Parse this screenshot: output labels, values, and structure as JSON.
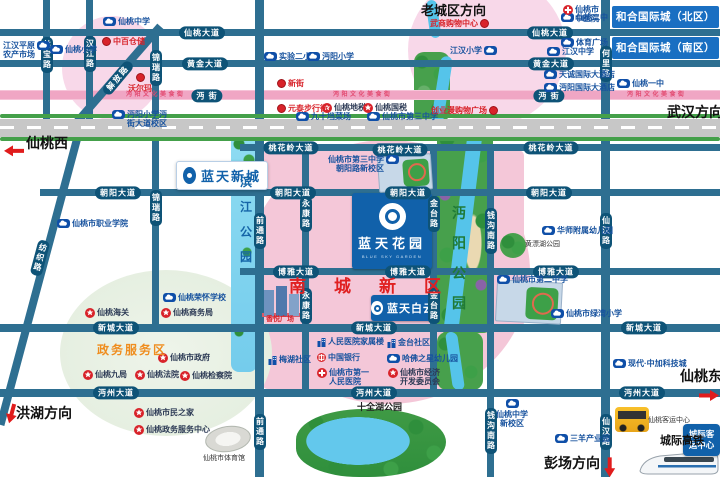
{
  "colors": {
    "road": "#2e6f91",
    "road_label_bg": "#0e5377",
    "pink_zone": "#f4c7d8",
    "pink_light": "#f8d8e9",
    "green_zone": "#e9f1e6",
    "river_blue": "#7cd4f0",
    "park_green": "#47a04c",
    "brand_blue": "#1161aa",
    "banner_blue": "#1a6fc2",
    "accent_red": "#d8232a",
    "highway_gray": "#c7c7c7"
  },
  "projects": {
    "xincheng": {
      "name": "蓝天新城"
    },
    "huayuan": {
      "name": "蓝天花园",
      "en": "BLUE SKY GARDEN"
    },
    "baiyun": {
      "name": "蓝天白云"
    },
    "chengji": {
      "name": "城际客运中心"
    }
  },
  "map": {
    "items": [
      {
        "k": "hp",
        "t": "仙桃大道",
        "x": 202,
        "y": 33
      },
      {
        "k": "hp",
        "t": "仙桃大道",
        "x": 550,
        "y": 33
      },
      {
        "k": "hp",
        "t": "黄金大道",
        "x": 205,
        "y": 64
      },
      {
        "k": "hp",
        "t": "黄金大道",
        "x": 551,
        "y": 64
      },
      {
        "k": "hp",
        "t": "沔  街",
        "x": 207,
        "y": 96
      },
      {
        "k": "hp",
        "t": "沔  街",
        "x": 549,
        "y": 96
      },
      {
        "k": "hp",
        "t": "桃花岭大道",
        "x": 291,
        "y": 148
      },
      {
        "k": "hp",
        "t": "桃花岭大道",
        "x": 400,
        "y": 150
      },
      {
        "k": "hp",
        "t": "桃花岭大道",
        "x": 551,
        "y": 148
      },
      {
        "k": "hp",
        "t": "朝阳大道",
        "x": 118,
        "y": 193
      },
      {
        "k": "hp",
        "t": "朝阳大道",
        "x": 293,
        "y": 193
      },
      {
        "k": "hp",
        "t": "朝阳大道",
        "x": 408,
        "y": 193
      },
      {
        "k": "hp",
        "t": "朝阳大道",
        "x": 549,
        "y": 193
      },
      {
        "k": "hp",
        "t": "博雅大道",
        "x": 296,
        "y": 272
      },
      {
        "k": "hp",
        "t": "博雅大道",
        "x": 408,
        "y": 272
      },
      {
        "k": "hp",
        "t": "博雅大道",
        "x": 556,
        "y": 272
      },
      {
        "k": "hp",
        "t": "新城大道",
        "x": 116,
        "y": 328
      },
      {
        "k": "hp",
        "t": "新城大道",
        "x": 374,
        "y": 328
      },
      {
        "k": "hp",
        "t": "新城大道",
        "x": 644,
        "y": 328
      },
      {
        "k": "hp",
        "t": "沔州大道",
        "x": 116,
        "y": 393
      },
      {
        "k": "hp",
        "t": "沔州大道",
        "x": 374,
        "y": 393
      },
      {
        "k": "hp",
        "t": "沔州大道",
        "x": 642,
        "y": 393
      },
      {
        "k": "vp",
        "t": "丝宝路",
        "x": 47,
        "y": 55
      },
      {
        "k": "vp",
        "t": "汉江路",
        "x": 90,
        "y": 54
      },
      {
        "k": "vp",
        "t": "锦瑞路",
        "x": 156,
        "y": 68
      },
      {
        "k": "vp",
        "t": "锦瑞路",
        "x": 156,
        "y": 208
      },
      {
        "k": "vp",
        "t": "何里路",
        "x": 606,
        "y": 64
      },
      {
        "k": "vp",
        "t": "前通路",
        "x": 260,
        "y": 231
      },
      {
        "k": "vp",
        "t": "前通路",
        "x": 260,
        "y": 432
      },
      {
        "k": "vp",
        "t": "永康路",
        "x": 306,
        "y": 214
      },
      {
        "k": "vp",
        "t": "永康路",
        "x": 306,
        "y": 306
      },
      {
        "k": "vp",
        "t": "金台路",
        "x": 434,
        "y": 214
      },
      {
        "k": "vp",
        "t": "金台路",
        "x": 434,
        "y": 306
      },
      {
        "k": "vp",
        "t": "钱沟南路",
        "x": 491,
        "y": 231
      },
      {
        "k": "vp",
        "t": "钱沟南路",
        "x": 491,
        "y": 431
      },
      {
        "k": "vp",
        "t": "仙汉路",
        "x": 606,
        "y": 231
      },
      {
        "k": "vp",
        "t": "仙汉路",
        "x": 606,
        "y": 432
      },
      {
        "k": "vp",
        "t": "纺织路",
        "x": 40,
        "y": 258,
        "rot": 15
      },
      {
        "k": "dp",
        "t": "解放路",
        "x": 118,
        "y": 78,
        "rot": -50
      },
      {
        "k": "pin",
        "t": "仙桃中学",
        "x": 103,
        "y": 17
      },
      {
        "k": "pin",
        "t": "江汉平原\n农产市场",
        "x": 3,
        "y": 41,
        "side": "l"
      },
      {
        "k": "pin",
        "t": "仙桃小学",
        "x": 50,
        "y": 45
      },
      {
        "k": "pin",
        "t": "实验二小",
        "x": 264,
        "y": 52
      },
      {
        "k": "pin",
        "t": "沔阳小学",
        "x": 307,
        "y": 52
      },
      {
        "k": "pin",
        "t": "九十垱菜场",
        "x": 296,
        "y": 112
      },
      {
        "k": "pin",
        "t": "仙桃市第三中学",
        "x": 367,
        "y": 112
      },
      {
        "k": "pin",
        "t": "沔阳小学沔\n街大道校区",
        "x": 112,
        "y": 110
      },
      {
        "k": "pin",
        "t": "江汉小学",
        "x": 450,
        "y": 46,
        "side": "l"
      },
      {
        "k": "pin",
        "t": "仙桃二中",
        "x": 561,
        "y": 13
      },
      {
        "k": "pin",
        "t": "体育广场",
        "x": 561,
        "y": 38
      },
      {
        "k": "pin",
        "t": "江汉中学",
        "x": 547,
        "y": 47
      },
      {
        "k": "pin",
        "t": "天诚国际大酒店",
        "x": 544,
        "y": 70
      },
      {
        "k": "pin",
        "t": "沔阳国际大酒店",
        "x": 544,
        "y": 83
      },
      {
        "k": "pin",
        "t": "仙桃一中",
        "x": 617,
        "y": 79
      },
      {
        "k": "pin",
        "t": "仙桃市职业学院",
        "x": 57,
        "y": 219
      },
      {
        "k": "pin",
        "t": "仙桃市第三中学\n朝阳路新校区",
        "x": 328,
        "y": 155,
        "side": "l"
      },
      {
        "k": "pin",
        "t": "华师附属幼儿园",
        "x": 542,
        "y": 226
      },
      {
        "k": "pin",
        "t": "仙桃市第二中学",
        "x": 497,
        "y": 275
      },
      {
        "k": "pin",
        "t": "仙桃市绿湾小学",
        "x": 551,
        "y": 309
      },
      {
        "k": "pin",
        "t": "仙桃荣怀学校",
        "x": 163,
        "y": 293
      },
      {
        "k": "pin",
        "t": "哈佛之星幼儿园",
        "x": 387,
        "y": 354
      },
      {
        "k": "pin",
        "t": "现代·中加科技城",
        "x": 613,
        "y": 359
      },
      {
        "k": "pin",
        "t": "仙桃中学\n新校区",
        "x": 496,
        "y": 399,
        "side": "b"
      },
      {
        "k": "pin",
        "t": "三羊产业园",
        "x": 555,
        "y": 434
      },
      {
        "k": "bldg",
        "t": "梅湖社区",
        "x": 268,
        "y": 355
      },
      {
        "k": "bldg",
        "t": "人民医院家属楼",
        "x": 317,
        "y": 337
      },
      {
        "k": "bldg",
        "t": "金台社区",
        "x": 387,
        "y": 338
      },
      {
        "k": "bank",
        "t": "中国银行",
        "x": 317,
        "y": 353
      },
      {
        "k": "cross",
        "t": "仙桃市\n中医院",
        "x": 563,
        "y": 5
      },
      {
        "k": "cross",
        "t": "仙桃市第一\n人民医院",
        "x": 317,
        "y": 368
      },
      {
        "k": "star",
        "t": "仙桃地税",
        "x": 322,
        "y": 103
      },
      {
        "k": "star",
        "t": "仙桃国税",
        "x": 363,
        "y": 103
      },
      {
        "k": "star",
        "t": "仙桃海关",
        "x": 85,
        "y": 308
      },
      {
        "k": "star",
        "t": "仙桃商务局",
        "x": 161,
        "y": 308
      },
      {
        "k": "star",
        "t": "仙桃市政府",
        "x": 158,
        "y": 353
      },
      {
        "k": "star",
        "t": "仙桃九局",
        "x": 83,
        "y": 370
      },
      {
        "k": "star",
        "t": "仙桃法院",
        "x": 135,
        "y": 370
      },
      {
        "k": "star",
        "t": "仙桃检察院",
        "x": 180,
        "y": 371
      },
      {
        "k": "star",
        "t": "仙桃市民之家",
        "x": 134,
        "y": 408
      },
      {
        "k": "star",
        "t": "仙桃政务服务中心",
        "x": 134,
        "y": 425
      },
      {
        "k": "star",
        "t": "仙桃市经济\n开发委员会",
        "x": 388,
        "y": 368
      },
      {
        "k": "dot",
        "t": "中百仓储",
        "x": 102,
        "y": 37
      },
      {
        "k": "dot",
        "t": "沃尔玛",
        "x": 128,
        "y": 73,
        "side": "b"
      },
      {
        "k": "dot",
        "t": "新街",
        "x": 277,
        "y": 79
      },
      {
        "k": "dot",
        "t": "元泰步行街",
        "x": 277,
        "y": 104
      },
      {
        "k": "red",
        "t": "武商购物中心",
        "x": 430,
        "y": 19
      },
      {
        "k": "red",
        "t": "创业漫购物广场",
        "x": 431,
        "y": 106
      },
      {
        "k": "plain",
        "t": "香悦广场",
        "x": 266,
        "y": 316,
        "c": "#d8232a",
        "fs": 7,
        "b": 1
      },
      {
        "k": "onroad",
        "t": "沔阳文化美食街",
        "x": 126,
        "y": 92
      },
      {
        "k": "onroad",
        "t": "沔阳文化美食街",
        "x": 333,
        "y": 92
      },
      {
        "k": "onroad",
        "t": "沔阳文化美食街",
        "x": 627,
        "y": 92
      },
      {
        "k": "parkv",
        "t": "滨江公园",
        "x": 240,
        "y": 170,
        "c": "#1565a8",
        "fs": 12,
        "lh": 25
      },
      {
        "k": "parkv",
        "t": "沔阳公园",
        "x": 452,
        "y": 198,
        "c": "#1f7a36",
        "fs": 14,
        "lh": 30
      },
      {
        "k": "plain",
        "t": "黄漂湖公园",
        "x": 525,
        "y": 241,
        "fs": 7
      },
      {
        "k": "plain",
        "t": "十全湖公园",
        "x": 357,
        "y": 402,
        "fs": 9,
        "b": 1,
        "c": "#222222"
      },
      {
        "k": "plain",
        "t": "仙桃市体育馆",
        "x": 203,
        "y": 455,
        "fs": 7
      },
      {
        "k": "plain",
        "t": "仙桃客运中心",
        "x": 648,
        "y": 417,
        "fs": 7
      },
      {
        "k": "plain",
        "t": "城际高铁",
        "x": 660,
        "y": 435,
        "fs": 11,
        "b": 1,
        "c": "#111111"
      },
      {
        "k": "black",
        "t": "老城区方向",
        "x": 421,
        "y": 4,
        "fs": 13
      },
      {
        "k": "black",
        "t": "武汉方向",
        "x": 667,
        "y": 106,
        "fs": 14
      },
      {
        "k": "black",
        "t": "仙桃西",
        "x": 26,
        "y": 137,
        "fs": 14
      },
      {
        "k": "black",
        "t": "仙桃东",
        "x": 680,
        "y": 370,
        "fs": 14
      },
      {
        "k": "black",
        "t": "洪湖方向",
        "x": 16,
        "y": 407,
        "fs": 14
      },
      {
        "k": "black",
        "t": "彭场方向",
        "x": 544,
        "y": 457,
        "fs": 14
      },
      {
        "k": "arrow",
        "x": 4,
        "y": 140,
        "rot": 180
      },
      {
        "k": "arrow",
        "x": 699,
        "y": 388,
        "rot": 0
      },
      {
        "k": "arrow",
        "x": 0,
        "y": 404,
        "rot": 105
      },
      {
        "k": "arrow",
        "x": 598,
        "y": 458,
        "rot": 90
      },
      {
        "k": "banner",
        "t": "和合国际城（北区）",
        "x": 612,
        "y": 6,
        "w": 107,
        "h": 22
      },
      {
        "k": "banner",
        "t": "和合国际城（南区）",
        "x": 612,
        "y": 37,
        "w": 107,
        "h": 22
      },
      {
        "k": "bigred",
        "t": "南城新区",
        "x": 289,
        "y": 277
      },
      {
        "k": "zone",
        "t": "政务服务区",
        "x": 97,
        "y": 344
      }
    ]
  }
}
